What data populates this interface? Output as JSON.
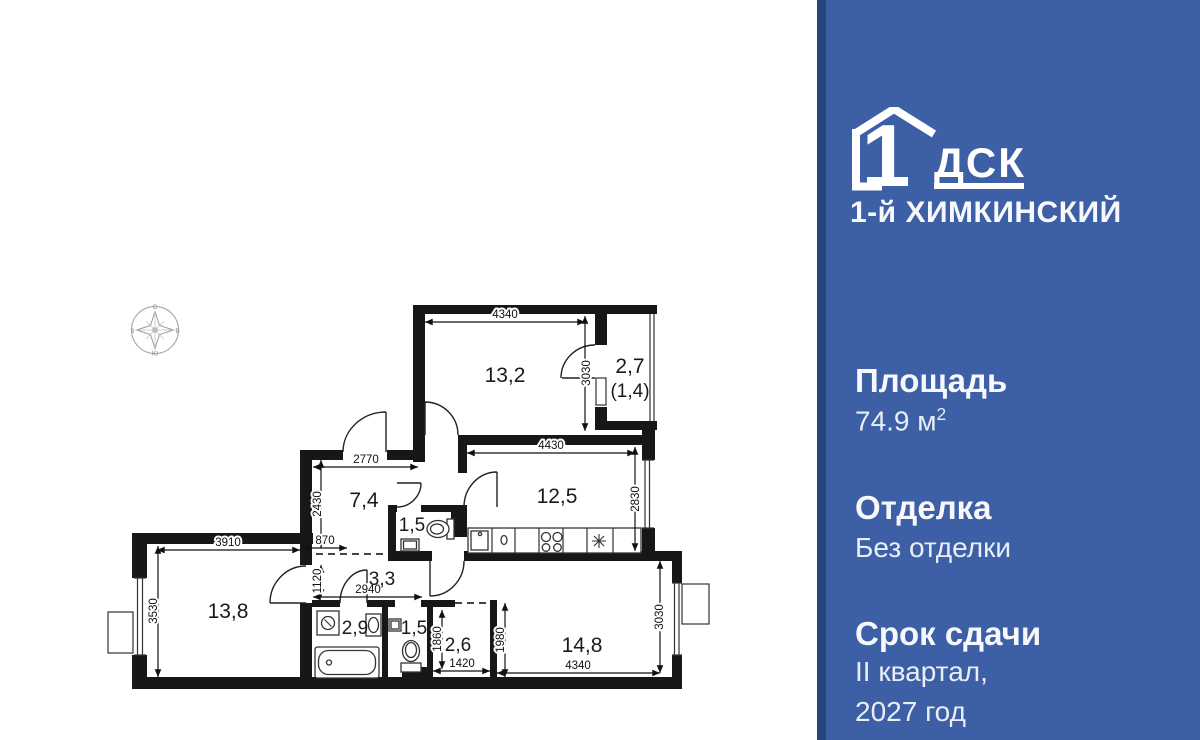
{
  "panel": {
    "logo": {
      "digit": "1",
      "brand": "ДСК",
      "project": "1-й ХИМКИНСКИЙ"
    },
    "specs": [
      {
        "label": "Площадь",
        "value": "74.9 м",
        "sup": "2"
      },
      {
        "label": "Отделка",
        "value": "Без отделки"
      },
      {
        "label": "Срок сдачи",
        "value_lines": [
          "II квартал,",
          "2027 год"
        ]
      }
    ]
  },
  "plan": {
    "compass": {
      "n": "С",
      "e": "В",
      "s": "Ю",
      "w": "З"
    },
    "rooms": [
      {
        "name": "room-13-2",
        "label": "13,2"
      },
      {
        "name": "balcony",
        "label": "2,7",
        "label2": "(1,4)"
      },
      {
        "name": "hallway",
        "label": "7,4"
      },
      {
        "name": "wc-upper",
        "label": "1,5"
      },
      {
        "name": "kitchen",
        "label": "12,5"
      },
      {
        "name": "corridor",
        "label": "3,3"
      },
      {
        "name": "room-13-8",
        "label": "13,8"
      },
      {
        "name": "bathroom",
        "label": "2,9"
      },
      {
        "name": "wc-lower",
        "label": "1,5"
      },
      {
        "name": "closet",
        "label": "2,6"
      },
      {
        "name": "room-14-8",
        "label": "14,8"
      }
    ],
    "dims": [
      {
        "label": "4340"
      },
      {
        "label": "3030"
      },
      {
        "label": "4430"
      },
      {
        "label": "2830"
      },
      {
        "label": "2770"
      },
      {
        "label": "2430"
      },
      {
        "label": "870"
      },
      {
        "label": "3910"
      },
      {
        "label": "3530"
      },
      {
        "label": "1120"
      },
      {
        "label": "2940"
      },
      {
        "label": "1860"
      },
      {
        "label": "1420"
      },
      {
        "label": "1980"
      },
      {
        "label": "4340"
      },
      {
        "label": "3030"
      }
    ]
  }
}
